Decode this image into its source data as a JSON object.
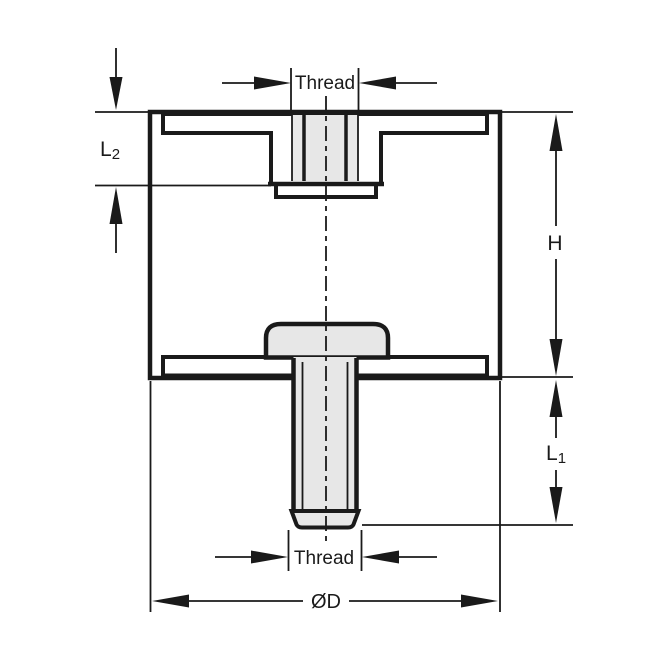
{
  "drawing": {
    "labels": {
      "thread_top": "Thread",
      "thread_bottom": "Thread",
      "height": "H",
      "l1_main": "L",
      "l1_sub": "1",
      "l2_main": "L",
      "l2_sub": "2",
      "diameter": "ØD"
    },
    "colors": {
      "line": "#1a1a1a",
      "fill": "#e7e7e7",
      "background": "#ffffff"
    }
  }
}
